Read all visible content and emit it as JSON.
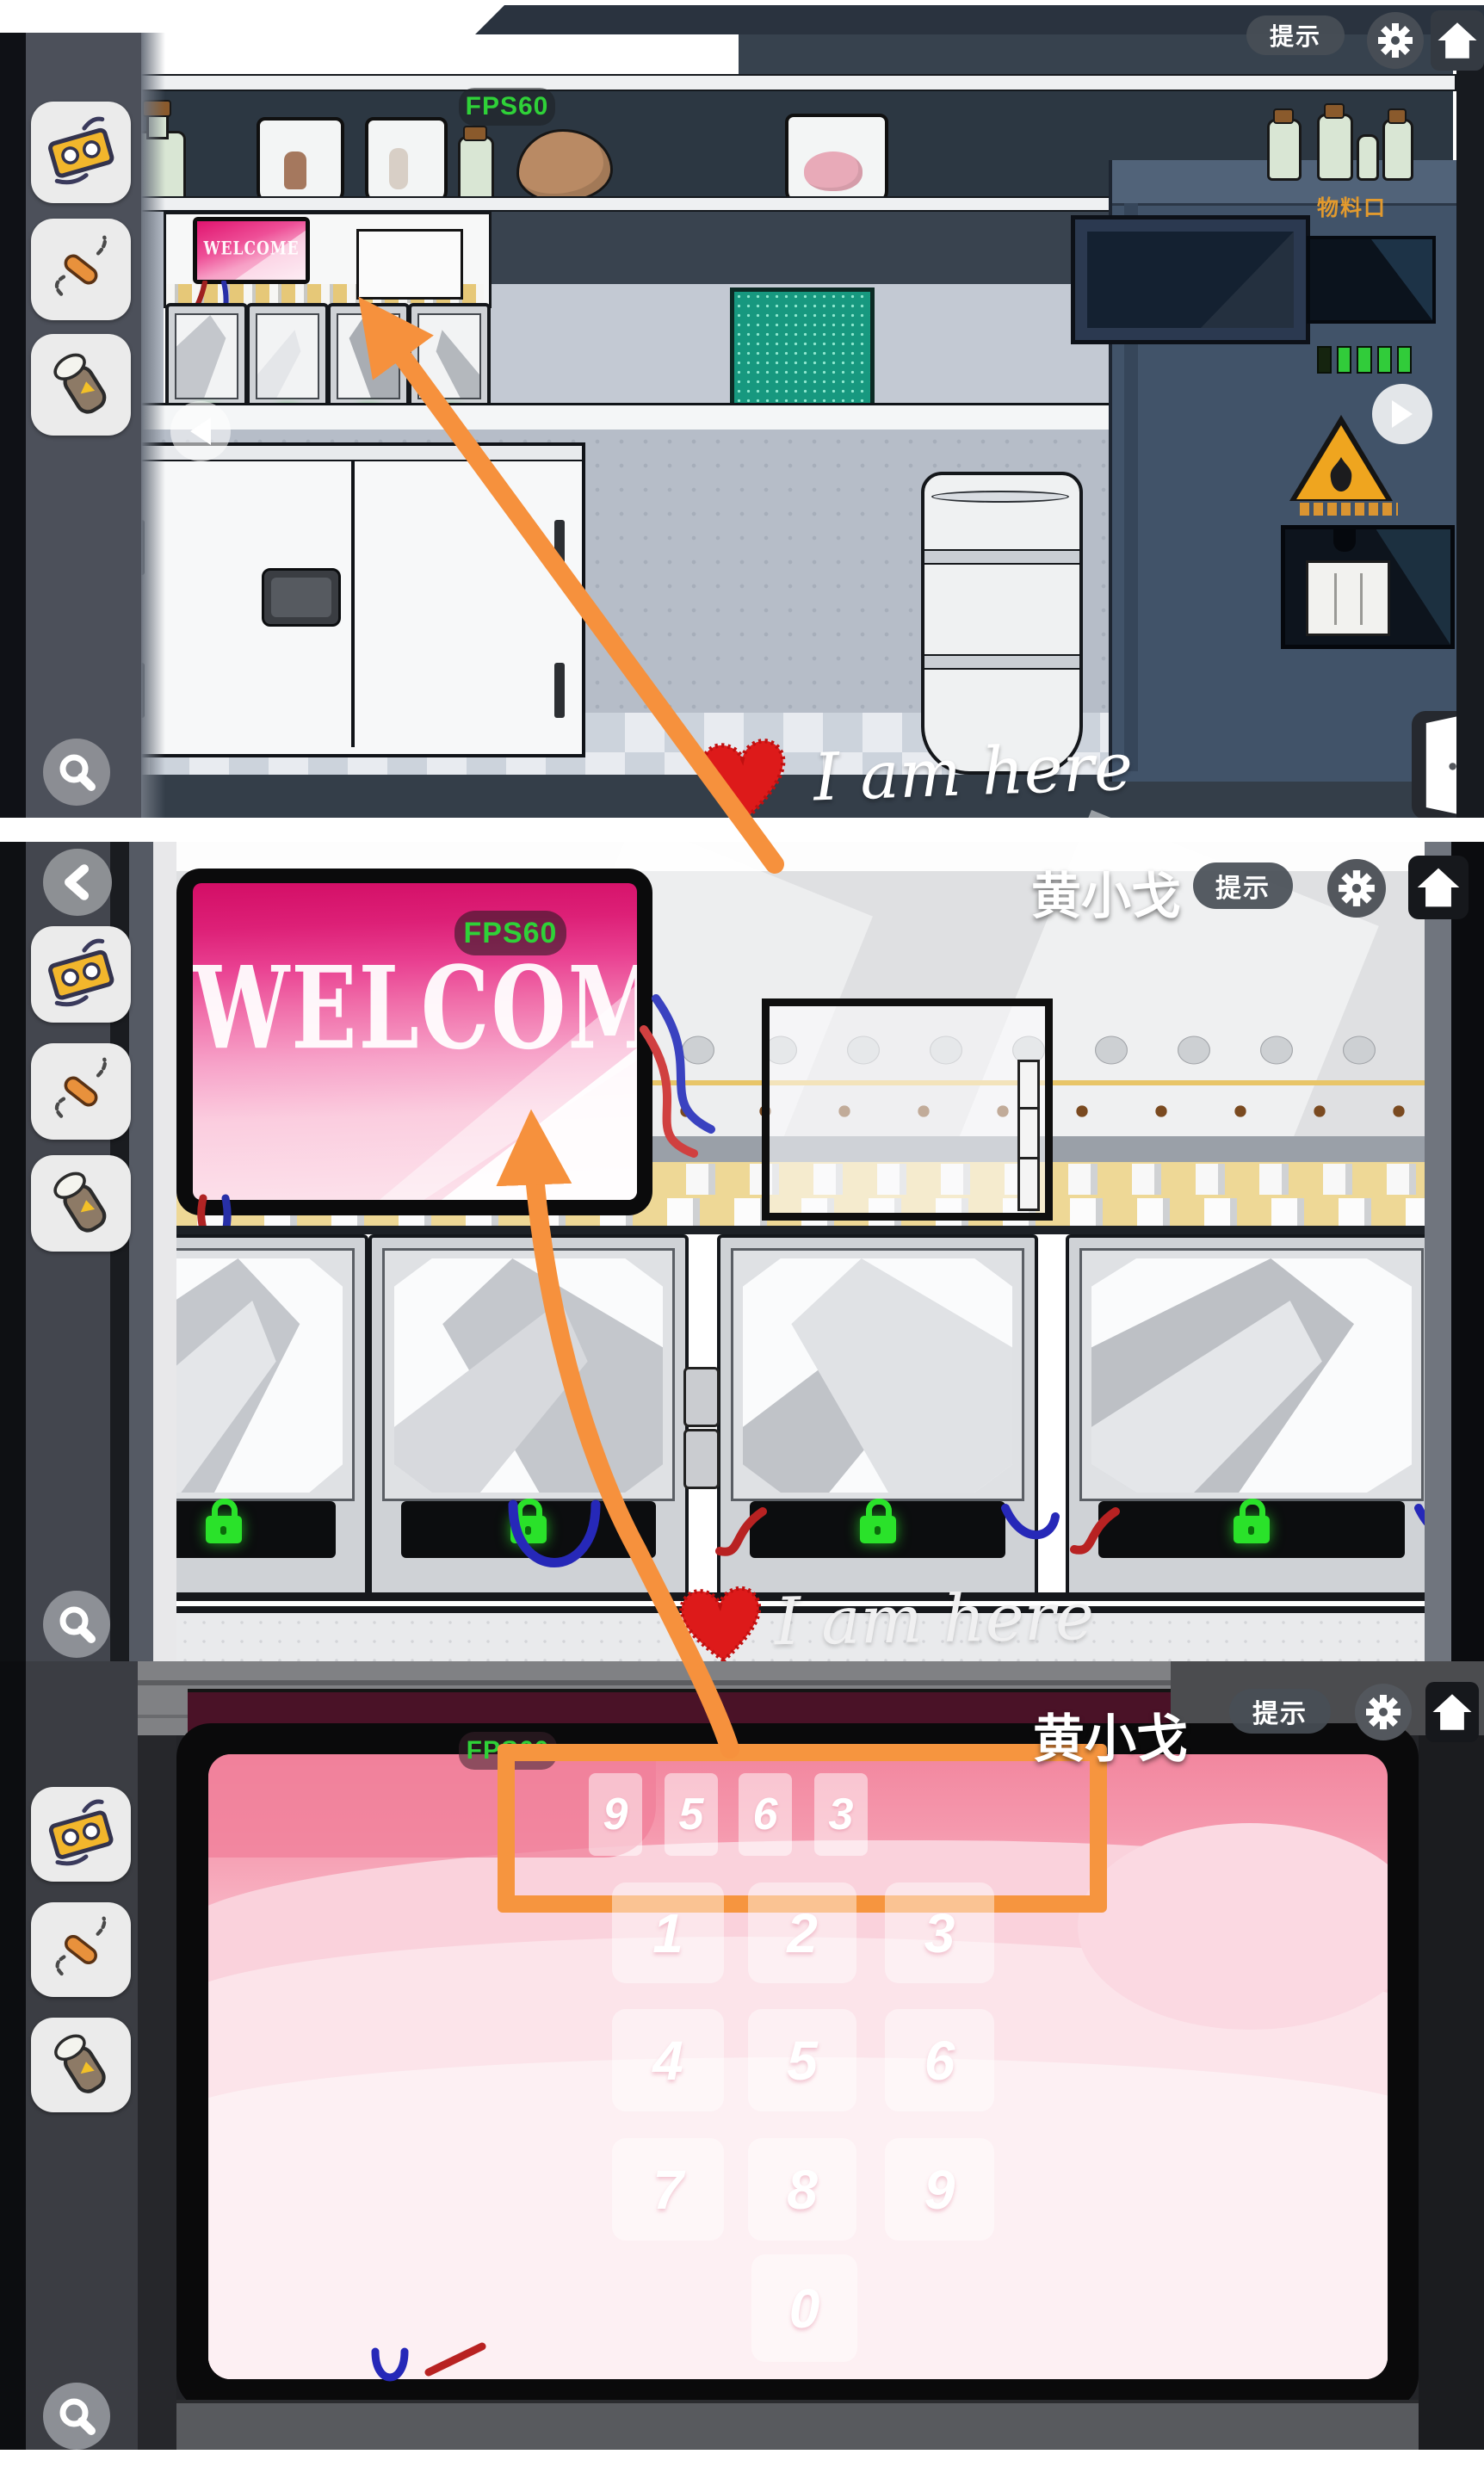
{
  "header": {
    "hint_label": "提示",
    "player_name": "黄小戈",
    "fps_label": "FPS60"
  },
  "panel1": {
    "welcome_text": "WELCOME",
    "machine": {
      "port_label": "物料口"
    },
    "annotation": {
      "text": "I am here"
    }
  },
  "panel2": {
    "welcome_text": "WELCOME",
    "annotation": {
      "text": "I am here"
    }
  },
  "panel3": {
    "code_digits": [
      "9",
      "5",
      "6",
      "3"
    ],
    "keypad_digits": [
      "1",
      "2",
      "3",
      "4",
      "5",
      "6",
      "7",
      "8",
      "9",
      "0"
    ]
  },
  "icons": {
    "gear": "settings-gear",
    "home": "home-house",
    "search": "magnifier",
    "back": "chevron-left",
    "nav_left": "triangle-left",
    "nav_right": "triangle-right",
    "door": "open-door",
    "lock": "green-padlock",
    "heart": "red-heart",
    "inventory": [
      "cassette-tape-item",
      "syringe-wire-item",
      "specimen-bottle-item"
    ]
  },
  "colors": {
    "annotation_orange": "#f6913d",
    "lock_green": "#2ae22a",
    "fps_green": "#2fd138",
    "screen_magenta": "#d30e66",
    "keypad_pink": "#f8b5c5",
    "warning_yellow": "#efa51f"
  }
}
